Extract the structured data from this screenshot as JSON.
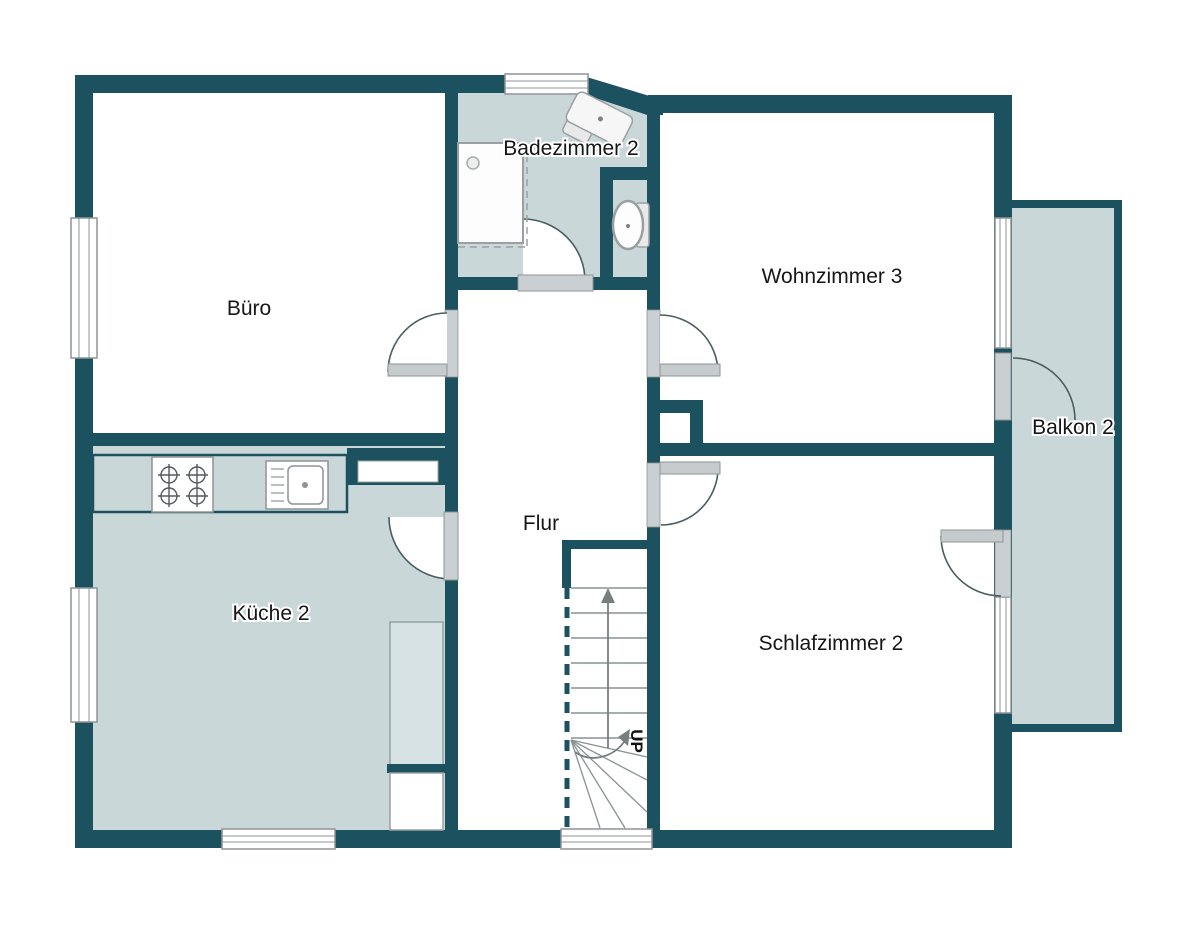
{
  "floorplan": {
    "rooms": {
      "buero": {
        "label": "Büro"
      },
      "badezimmer": {
        "label": "Badezimmer 2"
      },
      "wohnzimmer": {
        "label": "Wohnzimmer 3"
      },
      "balkon": {
        "label": "Balkon 2"
      },
      "kueche": {
        "label": "Küche 2"
      },
      "flur": {
        "label": "Flur"
      },
      "schlafzimmer": {
        "label": "Schlafzimmer 2"
      }
    },
    "stairs": {
      "direction_label": "UP"
    },
    "colors": {
      "wall": "#1c5260",
      "wet_room_fill": "#c9d7d9",
      "dry_room_fill": "#ffffff",
      "door_opening_fill": "#c9cfd2",
      "door_leaf_fill": "#c6cbcd",
      "fixture_outline": "#8f9496",
      "stair_line": "#8a9294",
      "arc_line": "#4a5d61"
    }
  }
}
